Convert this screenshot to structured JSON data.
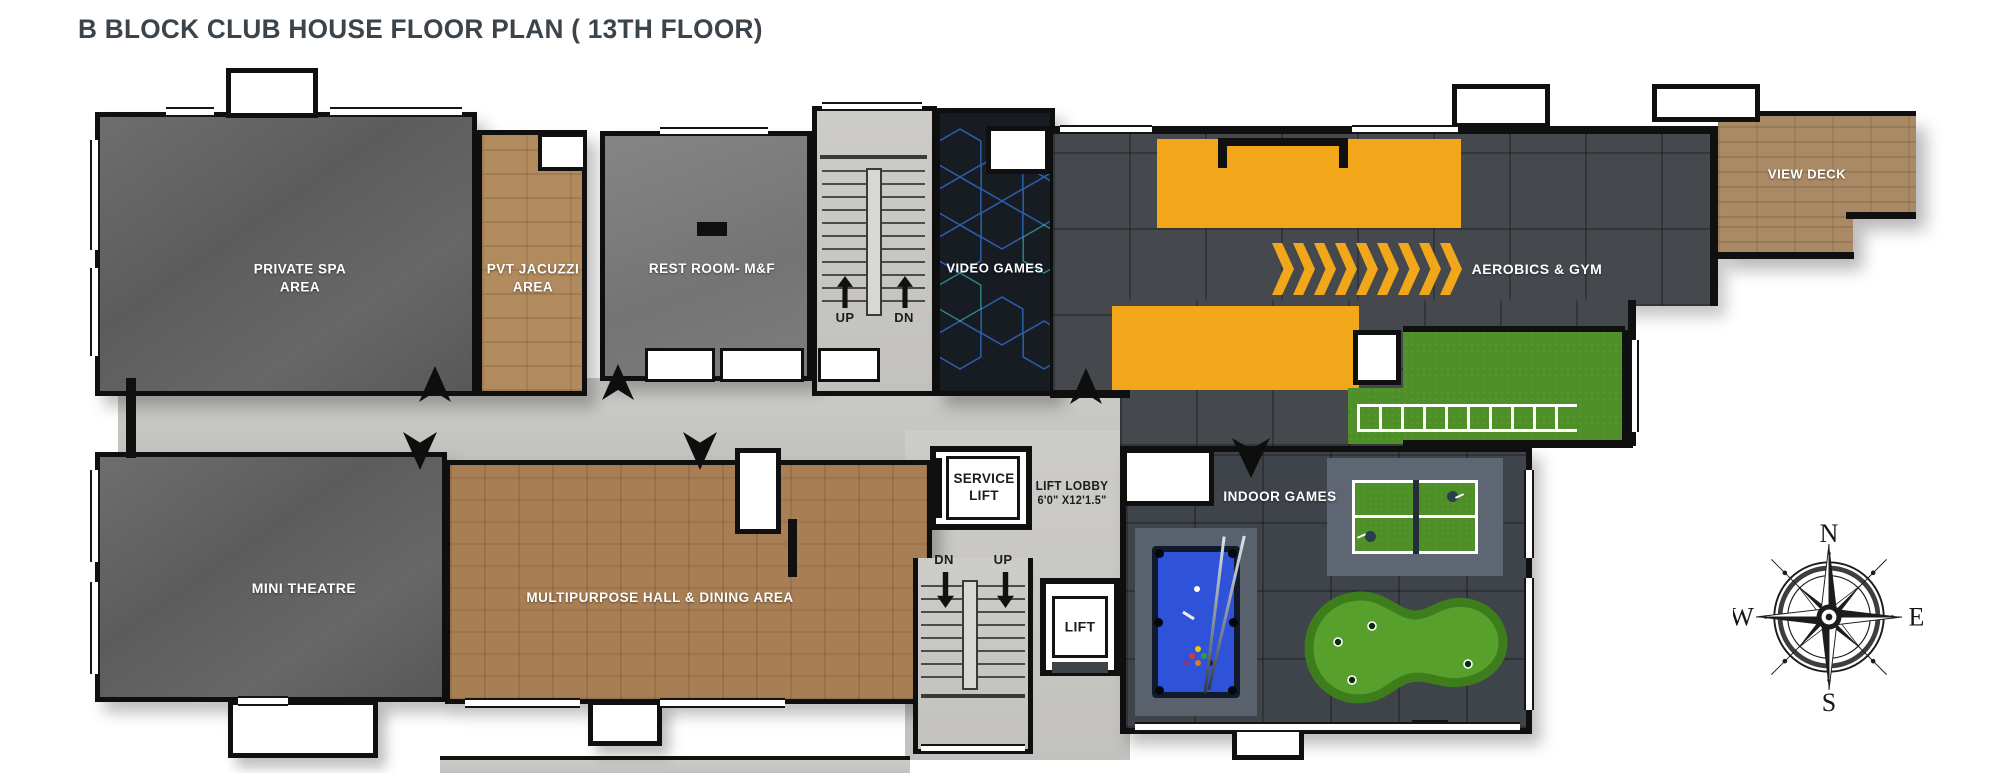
{
  "title": "B BLOCK CLUB HOUSE FLOOR PLAN ( 13TH FLOOR)",
  "rooms": {
    "private_spa": "PRIVATE SPA\nAREA",
    "pvt_jacuzzi": "PVT JACUZZI\nAREA",
    "rest_room": "REST ROOM- M&F",
    "video_games": "VIDEO GAMES",
    "aerobics_gym": "AEROBICS & GYM",
    "view_deck": "VIEW DECK",
    "mini_theatre": "MINI THEATRE",
    "multipurpose_hall": "MULTIPURPOSE HALL & DINING AREA",
    "indoor_games": "INDOOR GAMES"
  },
  "stairs_top": {
    "up": "UP",
    "dn": "DN"
  },
  "stairs_bottom": {
    "dn": "DN",
    "up": "UP"
  },
  "lifts": {
    "service_lift": "SERVICE\nLIFT",
    "lift": "LIFT",
    "lift_lobby": "LIFT LOBBY",
    "lift_lobby_size": "6'0\" X12'1.5\""
  },
  "compass": {
    "north": "N",
    "east": "E",
    "south": "S",
    "west": "W"
  },
  "colors": {
    "accent_yellow": "#F2A71B",
    "wall_black": "#101010",
    "concrete_dark_room": "#636363",
    "concrete_light_corridor": "#C9C8C4",
    "wood_floor": "#A87F55",
    "gym_tile": "#45494E",
    "turf_green": "#4F8F27",
    "pool_table_blue": "#2E52D8",
    "video_games_floor": "#171B22",
    "title_text": "#3B434B"
  }
}
